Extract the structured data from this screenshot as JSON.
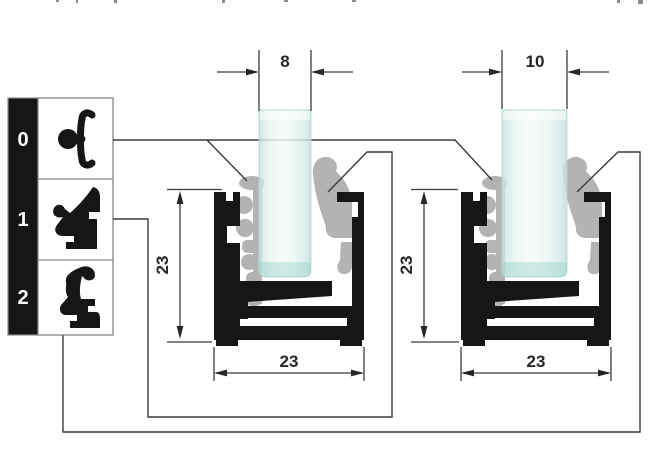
{
  "legend": {
    "rows": [
      {
        "number": "0",
        "icon": "clip-gasket-icon"
      },
      {
        "number": "1",
        "icon": "large-wedge-gasket-icon"
      },
      {
        "number": "2",
        "icon": "small-wedge-gasket-icon"
      }
    ]
  },
  "diagrams": {
    "left": {
      "glass_width": "8",
      "profile_height": "23",
      "profile_width": "23"
    },
    "right": {
      "glass_width": "10",
      "profile_height": "23",
      "profile_width": "23"
    }
  },
  "colors": {
    "profile_black": "#161616",
    "gasket_gray": "#b3b3b3",
    "line": "#3c3c3c",
    "glass_edge": "#bfe0da",
    "glass_center": "#f4fbf9"
  }
}
